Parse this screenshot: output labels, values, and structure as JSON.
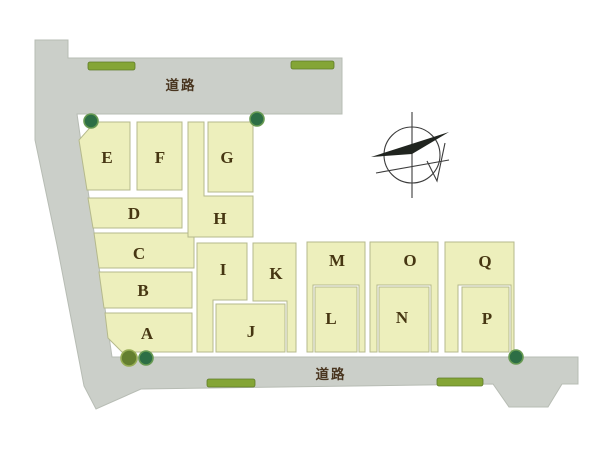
{
  "plan": {
    "kind": "land-subdivision-map",
    "width": 600,
    "height": 449
  },
  "colors": {
    "background": "#ffffff",
    "road_fill": "#cbcfc9",
    "road_edge": "#b7bcb4",
    "lot_fill": "#edefbc",
    "lot_edge": "#b5b98c",
    "hedge_fill": "#84a536",
    "hedge_edge": "#5f7c28",
    "bush_dark_fill": "#2d6e45",
    "bush_dark_edge": "#679a52",
    "bush_olive_fill": "#647f2f",
    "bush_olive_edge": "#97ad54",
    "lot_label_text": "#463612",
    "road_label_text": "#49351f",
    "compass_stroke": "#3c3c3c",
    "compass_fill": "#20241f"
  },
  "roads": {
    "path": "M35,40 L68,40 L68,58 L342,58 L342,114 L77,114 L112,357 L578,357 L578,384 L562,384 L548,407 L509,407 L493,384 L141,389 L96,409 L84,386 L80,365 L57,245 L35,140 Z",
    "labels": [
      {
        "text": "道路",
        "x": 181,
        "y": 90
      },
      {
        "text": "道路",
        "x": 331,
        "y": 379
      }
    ]
  },
  "lots": [
    {
      "id": "A",
      "label": "A",
      "points": "105,313 192,313 192,352 122,352 108,338",
      "label_pos": [
        147,
        339
      ]
    },
    {
      "id": "B",
      "label": "B",
      "points": "99,272 192,272 192,308 104,308",
      "label_pos": [
        143,
        296
      ]
    },
    {
      "id": "C",
      "label": "C",
      "points": "94,233 194,233 194,268 99,268",
      "label_pos": [
        139,
        259
      ]
    },
    {
      "id": "D",
      "label": "D",
      "points": "88,198 182,198 182,228 93,228",
      "label_pos": [
        134,
        219
      ]
    },
    {
      "id": "E",
      "label": "E",
      "points": "95,122 130,122 130,190 87,190 79,140",
      "label_pos": [
        107,
        163
      ]
    },
    {
      "id": "F",
      "label": "F",
      "points": "137,122 182,122 182,190 137,190",
      "label_pos": [
        160,
        163
      ]
    },
    {
      "id": "G",
      "label": "G",
      "points": "208,122 253,122 253,192 208,192",
      "label_pos": [
        227,
        163
      ]
    },
    {
      "id": "H",
      "label": "H",
      "points": "188,122 204,122 204,196 253,196 253,237 188,237",
      "label_pos": [
        220,
        224
      ]
    },
    {
      "id": "I",
      "label": "I",
      "points": "197,243 247,243 247,300 213,300 213,352 197,352",
      "label_pos": [
        223,
        275
      ]
    },
    {
      "id": "J",
      "label": "J",
      "points": "216,304 285,304 285,352 216,352",
      "label_pos": [
        251,
        337
      ]
    },
    {
      "id": "K",
      "label": "K",
      "points": "253,243 296,243 296,352 287,352 287,301 253,301",
      "label_pos": [
        276,
        279
      ]
    },
    {
      "id": "L",
      "label": "L",
      "points": "315,287 357,287 357,352 315,352",
      "label_pos": [
        331,
        324
      ]
    },
    {
      "id": "M",
      "label": "M",
      "points": "307,242 365,242 365,352 359,352 359,285 313,285 313,352 307,352",
      "label_pos": [
        337,
        266
      ]
    },
    {
      "id": "N",
      "label": "N",
      "points": "379,287 429,287 429,352 379,352",
      "label_pos": [
        402,
        323
      ]
    },
    {
      "id": "O",
      "label": "O",
      "points": "370,242 438,242 438,352 431,352 431,285 377,285 377,352 370,352",
      "label_pos": [
        410,
        266
      ]
    },
    {
      "id": "P",
      "label": "P",
      "points": "462,287 509,287 509,352 462,352",
      "label_pos": [
        487,
        324
      ]
    },
    {
      "id": "Q",
      "label": "Q",
      "points": "445,242 514,242 514,352 511,352 511,285 458,285 458,352 445,352",
      "label_pos": [
        485,
        267
      ]
    }
  ],
  "landscape": {
    "hedges": [
      {
        "x": 88,
        "y": 62,
        "w": 47,
        "h": 8
      },
      {
        "x": 291,
        "y": 61,
        "w": 43,
        "h": 8
      },
      {
        "x": 207,
        "y": 379,
        "w": 48,
        "h": 8
      },
      {
        "x": 437,
        "y": 378,
        "w": 46,
        "h": 8
      }
    ],
    "bushes": [
      {
        "cx": 91,
        "cy": 121,
        "r": 7,
        "tone": "dark"
      },
      {
        "cx": 257,
        "cy": 119,
        "r": 7,
        "tone": "dark"
      },
      {
        "cx": 129,
        "cy": 358,
        "r": 8,
        "tone": "olive"
      },
      {
        "cx": 146,
        "cy": 358,
        "r": 7,
        "tone": "dark"
      },
      {
        "cx": 516,
        "cy": 357,
        "r": 7,
        "tone": "dark"
      }
    ]
  },
  "compass": {
    "cx": 412,
    "cy": 155,
    "r": 28
  }
}
